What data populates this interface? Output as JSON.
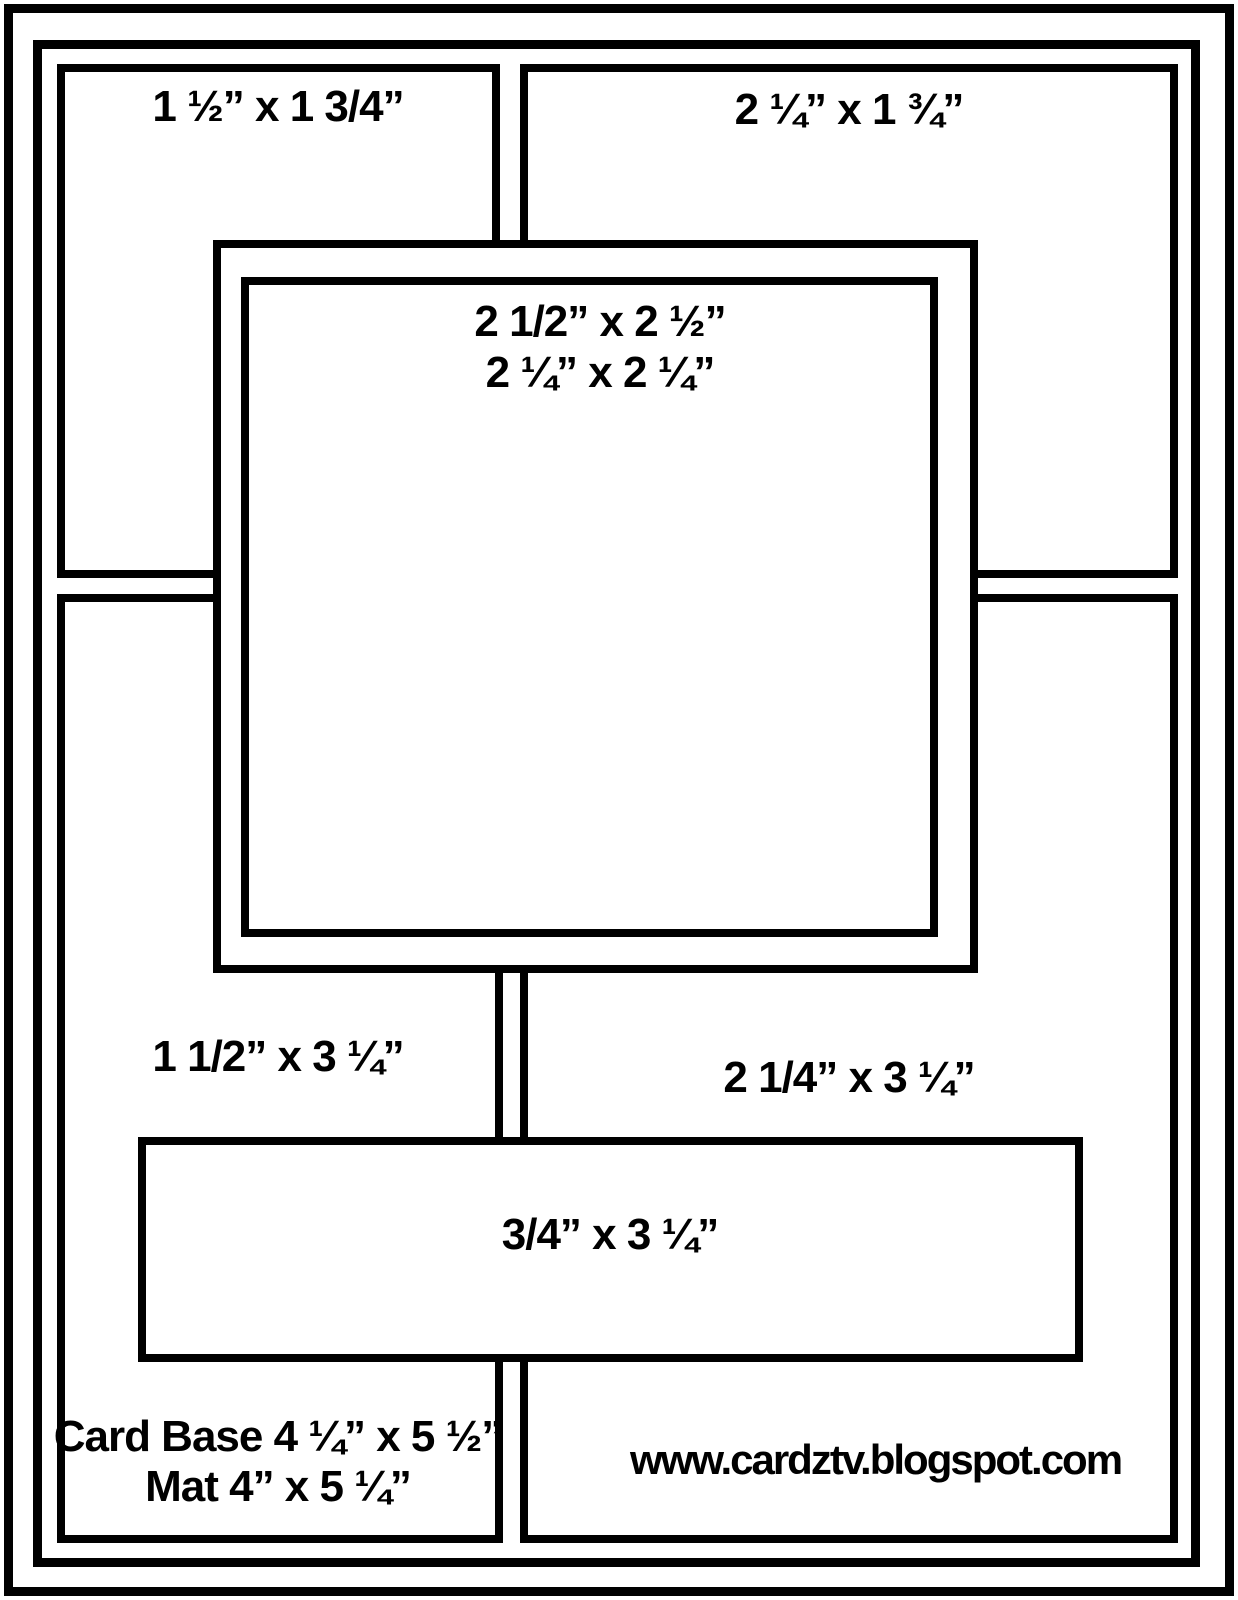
{
  "diagram": {
    "type": "card-making-sketch",
    "colors": {
      "line": "#000000",
      "background": "#ffffff"
    },
    "panels": {
      "top_left": {
        "label": "1 ½” x 1 3/4”"
      },
      "top_right": {
        "label": "2 ¼” x 1 ¾”"
      },
      "center_square": {
        "line1": "2 1/2” x 2 ½”",
        "line2": "2 ¼” x 2 ¼”"
      },
      "middle_left": {
        "label": "1 1/2” x 3 ¼”"
      },
      "middle_right": {
        "label": "2 1/4” x 3 ¼”"
      },
      "banner": {
        "label": "3/4” x 3 ¼”"
      },
      "card_base": {
        "line1": "Card Base 4 ¼” x 5 ½”",
        "line2": "Mat 4” x 5 ¼”"
      },
      "footer": {
        "url": "www.cardztv.blogspot.com"
      }
    }
  }
}
